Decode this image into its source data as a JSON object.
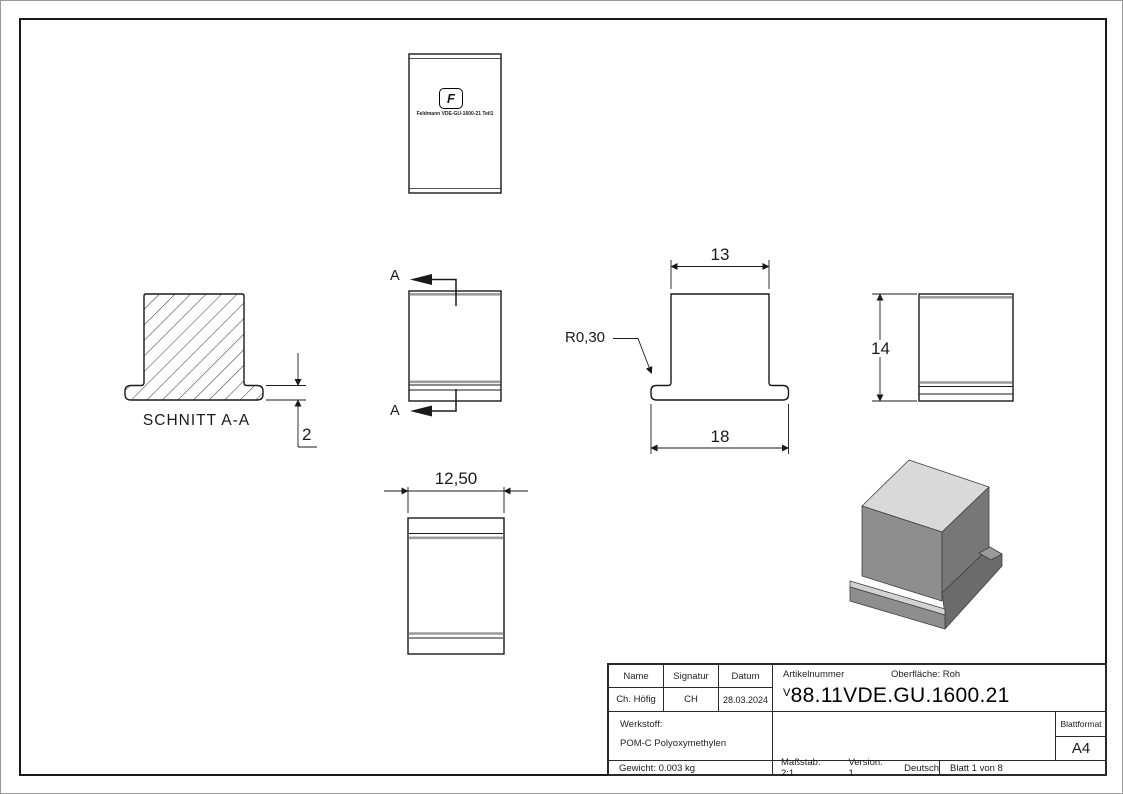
{
  "page": {
    "background": "#ffffff",
    "frame_color": "#1a1a1a",
    "shade_color": "#9c9c9c"
  },
  "views": {
    "top_view": {
      "logo_glyph": "F",
      "caption": "Feldmann VDE-GU-1600-21 Teil1"
    },
    "section_view": {
      "label": "SCHNITT A-A",
      "dim_flange_thickness": "2"
    },
    "front_view": {
      "section_marker": "A"
    },
    "profile_view": {
      "dim_body_width": "13",
      "dim_flange_width": "18",
      "radius_label": "R0,30"
    },
    "side_view": {
      "dim_height": "14"
    },
    "bottom_view": {
      "dim_width": "12,50"
    }
  },
  "isometric": {
    "top_face_color": "#d9d9d9",
    "front_face_color": "#8e8e8e",
    "right_face_color": "#777777",
    "flange_color": "#6b6b6b",
    "highlight_color": "#d2d2d2"
  },
  "title_block": {
    "name_label": "Name",
    "signature_label": "Signatur",
    "date_label": "Datum",
    "name_value": "Ch. Höfig",
    "signature_value": "CH",
    "date_value": "28.03.2024",
    "article_label": "Artikelnummer",
    "surface_label": "Oberfläche:  Roh",
    "article_prefix": "V",
    "article_number": "88.11VDE.GU.1600.21",
    "material_label": "Werkstoff:",
    "material_value": "POM-C Polyoxymethylen",
    "weight_value": "Gewicht: 0.003 kg",
    "scale_value": "Maßstab: 2:1",
    "version_value": "Version: 1",
    "language_value": "Deutsch",
    "sheet_value": "Blatt 1 von 8",
    "format_label": "Blattformat",
    "format_value": "A4"
  }
}
